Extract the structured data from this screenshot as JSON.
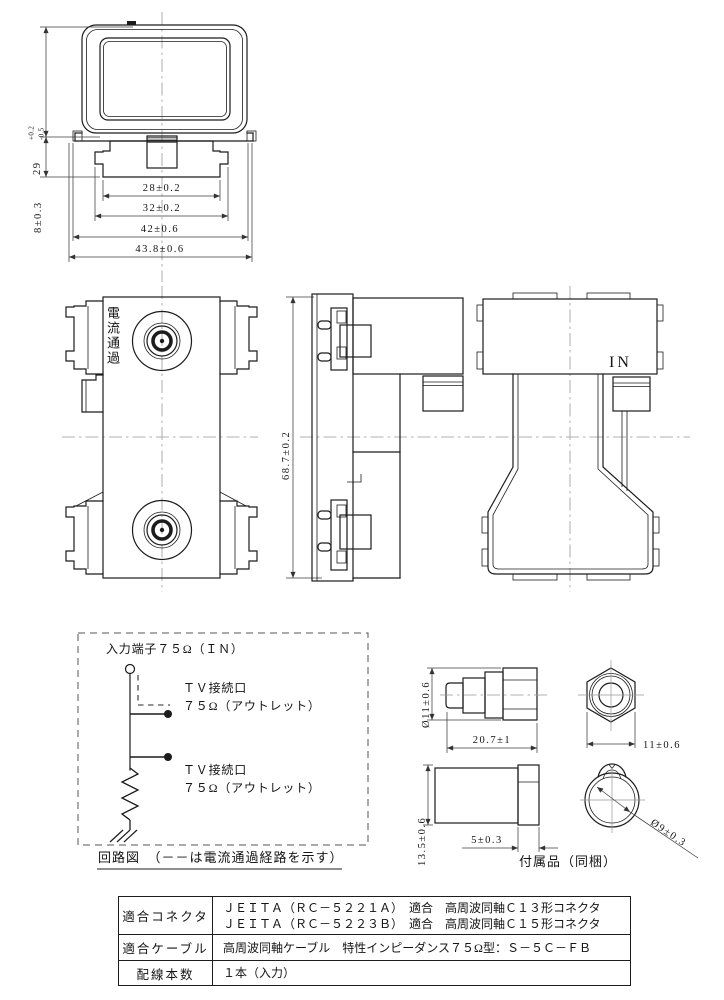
{
  "top_view": {
    "dim_height_main": "29",
    "dim_height_tol_plus": "+0.2",
    "dim_height_tol_minus": "-0.5",
    "dim_body_height": "8±0.3",
    "dim_w28": "28±0.2",
    "dim_w32": "32±0.2",
    "dim_w42": "42±0.6",
    "dim_w438": "43.8±0.6"
  },
  "front_view": {
    "vertical_label": "電流通過"
  },
  "side_view": {
    "dim_height": "68.7±0.2"
  },
  "back_view": {
    "port_label": "IN"
  },
  "circuit": {
    "input_label": "入力端子７５Ω（ＩＮ）",
    "outlet_top_line1": "ＴＶ接続口",
    "outlet_top_line2": "７５Ω（アウトレット）",
    "outlet_bottom_line1": "ＴＶ接続口",
    "outlet_bottom_line2": "７５Ω（アウトレット）",
    "caption": "回路図　（－－は電流通過経路を示す）"
  },
  "accessories": {
    "caption": "付属品（同梱）",
    "plug_diameter": "Ø11±0.6",
    "plug_length": "20.7±1",
    "nut_width": "11±0.6",
    "cap_height": "13.5±0.6",
    "cap_thickness": "5±0.3",
    "ring_diameter": "Ø9±0.3"
  },
  "spec_table": {
    "rows": [
      {
        "label": "適合コネクタ",
        "lines": [
          "ＪＥＩＴＡ（ＲＣ－５２２１Ａ）　適合　高周波同軸Ｃ１３形コネクタ",
          "ＪＥＩＴＡ（ＲＣ－５２２３Ｂ）　適合　高周波同軸Ｃ１５形コネクタ"
        ]
      },
      {
        "label": "適合ケーブル",
        "lines": [
          "高周波同軸ケーブル　特性インピーダンス７５Ω型：Ｓ－５Ｃ－ＦＢ"
        ]
      },
      {
        "label": "配線本数",
        "lines": [
          "１本（入力）"
        ]
      }
    ]
  }
}
